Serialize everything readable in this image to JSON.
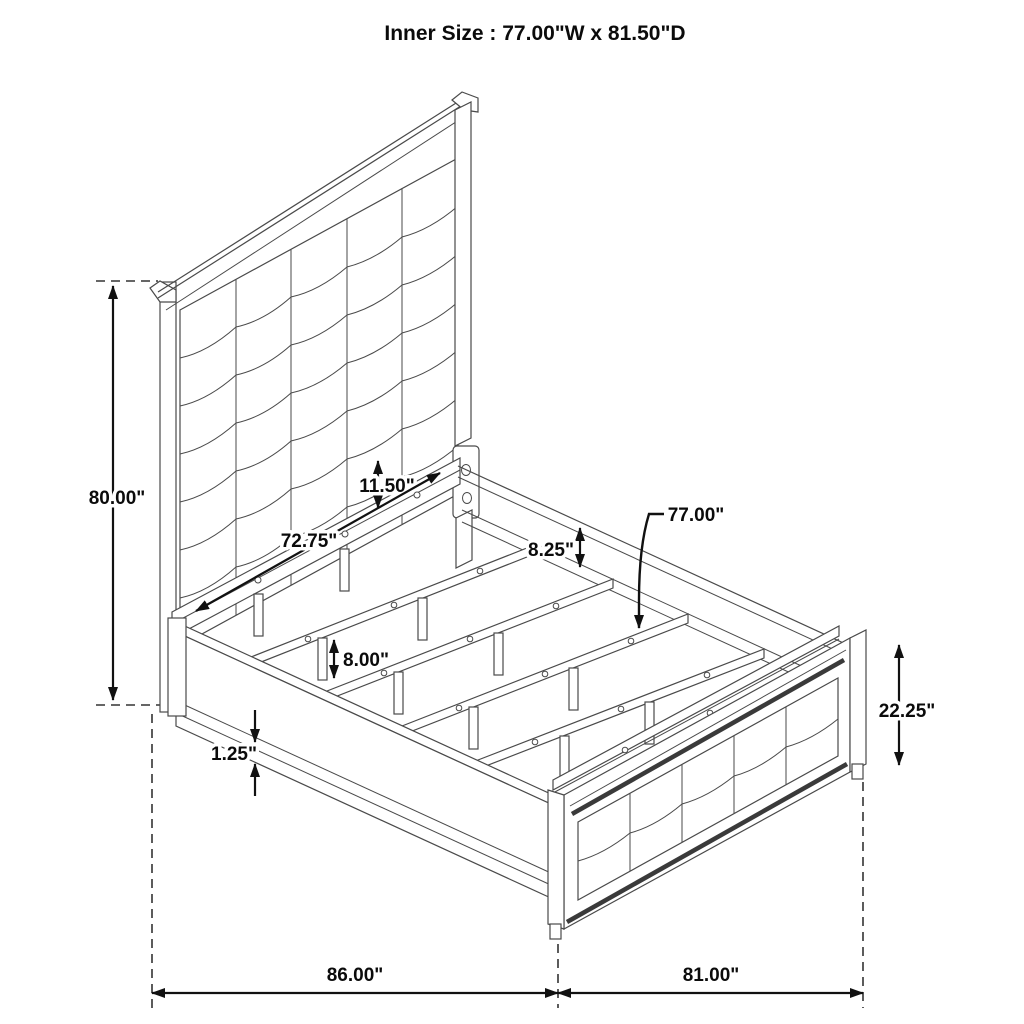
{
  "title": {
    "text": "Inner Size : 77.00\"W x 81.50\"D"
  },
  "colors": {
    "background": "#ffffff",
    "drawing_line": "#4a4a4a",
    "dimension_line": "#111111",
    "text": "#0b0b0b"
  },
  "dims": {
    "overall_height": "80.00\"",
    "panel_to_deck_gap": "11.50\"",
    "side_rail_length": "72.75\"",
    "side_rail_height": "8.25\"",
    "slat_length": "77.00\"",
    "support_leg_height": "8.00\"",
    "rail_lip_thickness": "1.25\"",
    "footboard_height": "22.25\"",
    "floor_length": "86.00\"",
    "floor_width": "81.00\""
  }
}
